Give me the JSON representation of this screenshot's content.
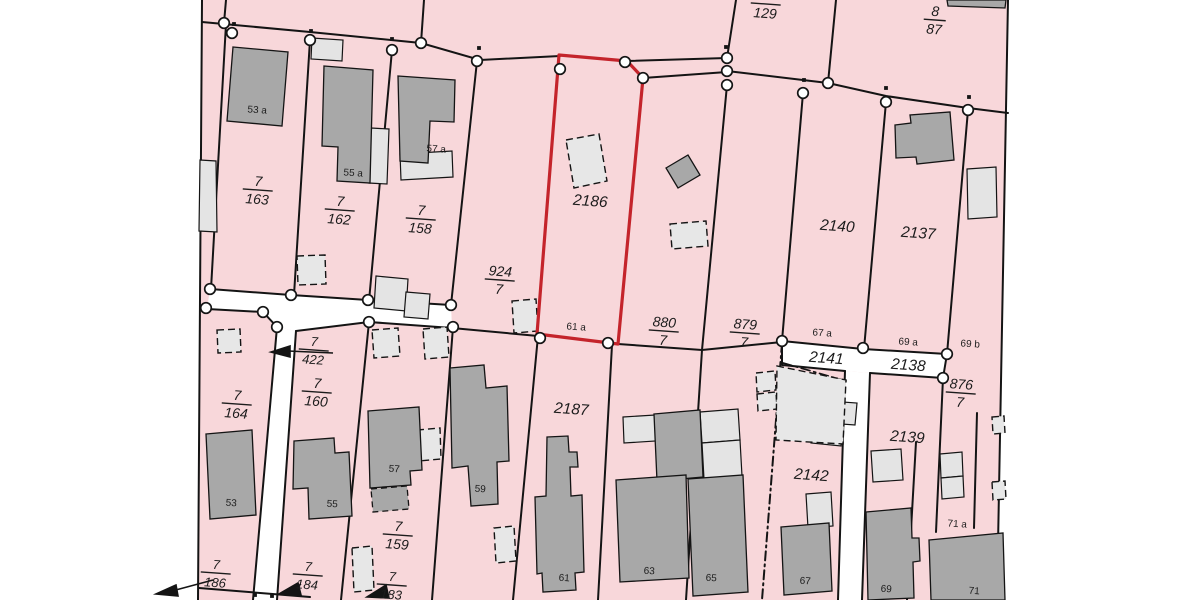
{
  "map": {
    "description": "cadastral parcel map with highlighted parcel",
    "colors": {
      "parcel_fill": "#f8d7da",
      "road_fill": "#ffffff",
      "boundary_line": "#141414",
      "building_dark": "#a8a8a8",
      "building_light": "#e4e4e4",
      "highlight_red": "#c4242b",
      "label_color": "#1c1c1c",
      "background": "#ffffff"
    },
    "highlighted_parcel": {
      "number": "2186",
      "house_label": "61 a"
    },
    "labels": [
      {
        "kind": "fraction",
        "num": "",
        "den": "129",
        "x": 766,
        "y": 0,
        "size": 14
      },
      {
        "kind": "fraction",
        "num": "8",
        "den": "87",
        "x": 935,
        "y": 16,
        "size": 14
      },
      {
        "kind": "fraction",
        "num": "7",
        "den": "163",
        "x": 258,
        "y": 186,
        "size": 14
      },
      {
        "kind": "fraction",
        "num": "7",
        "den": "162",
        "x": 340,
        "y": 206,
        "size": 14
      },
      {
        "kind": "fraction",
        "num": "7",
        "den": "158",
        "x": 421,
        "y": 215,
        "size": 14
      },
      {
        "kind": "fraction",
        "num": "924",
        "den": "7",
        "x": 500,
        "y": 276,
        "size": 14
      },
      {
        "kind": "fraction",
        "num": "880",
        "den": "7",
        "x": 664,
        "y": 327,
        "size": 14
      },
      {
        "kind": "fraction",
        "num": "879",
        "den": "7",
        "x": 745,
        "y": 329,
        "size": 14
      },
      {
        "kind": "fraction",
        "num": "876",
        "den": "7",
        "x": 961,
        "y": 389,
        "size": 14
      },
      {
        "kind": "fraction",
        "num": "7",
        "den": "422",
        "x": 314,
        "y": 346,
        "size": 13,
        "has_arrow": true
      },
      {
        "kind": "fraction",
        "num": "7",
        "den": "164",
        "x": 237,
        "y": 400,
        "size": 14
      },
      {
        "kind": "fraction",
        "num": "7",
        "den": "160",
        "x": 317,
        "y": 388,
        "size": 14
      },
      {
        "kind": "fraction",
        "num": "7",
        "den": "159",
        "x": 398,
        "y": 531,
        "size": 14
      },
      {
        "kind": "fraction",
        "num": "7",
        "den": "186",
        "x": 216,
        "y": 569,
        "size": 13,
        "has_arrow": true
      },
      {
        "kind": "fraction",
        "num": "7",
        "den": "184",
        "x": 308,
        "y": 571,
        "size": 13,
        "has_arrow": true
      },
      {
        "kind": "fraction",
        "num": "7",
        "den": "183",
        "x": 392,
        "y": 581,
        "size": 13,
        "has_arrow": true
      },
      {
        "kind": "parcel",
        "text": "2186",
        "x": 590,
        "y": 206,
        "size": 15.5
      },
      {
        "kind": "parcel",
        "text": "2187",
        "x": 571,
        "y": 414,
        "size": 15.5
      },
      {
        "kind": "parcel",
        "text": "2140",
        "x": 837,
        "y": 231,
        "size": 15.5
      },
      {
        "kind": "parcel",
        "text": "2137",
        "x": 918,
        "y": 238,
        "size": 15.5
      },
      {
        "kind": "parcel",
        "text": "2139",
        "x": 907,
        "y": 442,
        "size": 15.5
      },
      {
        "kind": "parcel",
        "text": "2142",
        "x": 811,
        "y": 480,
        "size": 15.5
      },
      {
        "kind": "parcel",
        "text": "2141",
        "x": 826,
        "y": 363,
        "size": 15.5
      },
      {
        "kind": "parcel",
        "text": "2138",
        "x": 908,
        "y": 370,
        "size": 15.5
      },
      {
        "kind": "house",
        "text": "53 a",
        "x": 257,
        "y": 113,
        "size": 10
      },
      {
        "kind": "house",
        "text": "55 a",
        "x": 353,
        "y": 176,
        "size": 10
      },
      {
        "kind": "house",
        "text": "57 a",
        "x": 436,
        "y": 152,
        "size": 10
      },
      {
        "kind": "house",
        "text": "61 a",
        "x": 576,
        "y": 330,
        "size": 10
      },
      {
        "kind": "house",
        "text": "67 a",
        "x": 822,
        "y": 336,
        "size": 10
      },
      {
        "kind": "house",
        "text": "69 a",
        "x": 908,
        "y": 345,
        "size": 10
      },
      {
        "kind": "house",
        "text": "69 b",
        "x": 970,
        "y": 347,
        "size": 10
      },
      {
        "kind": "house",
        "text": "71 a",
        "x": 957,
        "y": 527,
        "size": 10
      },
      {
        "kind": "house",
        "text": "53",
        "x": 231,
        "y": 506,
        "size": 10
      },
      {
        "kind": "house",
        "text": "55",
        "x": 332,
        "y": 507,
        "size": 10
      },
      {
        "kind": "house",
        "text": "57",
        "x": 394,
        "y": 472,
        "size": 10
      },
      {
        "kind": "house",
        "text": "59",
        "x": 480,
        "y": 492,
        "size": 10
      },
      {
        "kind": "house",
        "text": "61",
        "x": 564,
        "y": 581,
        "size": 10
      },
      {
        "kind": "house",
        "text": "63",
        "x": 649,
        "y": 574,
        "size": 10
      },
      {
        "kind": "house",
        "text": "65",
        "x": 711,
        "y": 581,
        "size": 10
      },
      {
        "kind": "house",
        "text": "67",
        "x": 805,
        "y": 584,
        "size": 10
      },
      {
        "kind": "house",
        "text": "69",
        "x": 886,
        "y": 592,
        "size": 10
      },
      {
        "kind": "house",
        "text": "71",
        "x": 974,
        "y": 594,
        "size": 10
      }
    ]
  }
}
